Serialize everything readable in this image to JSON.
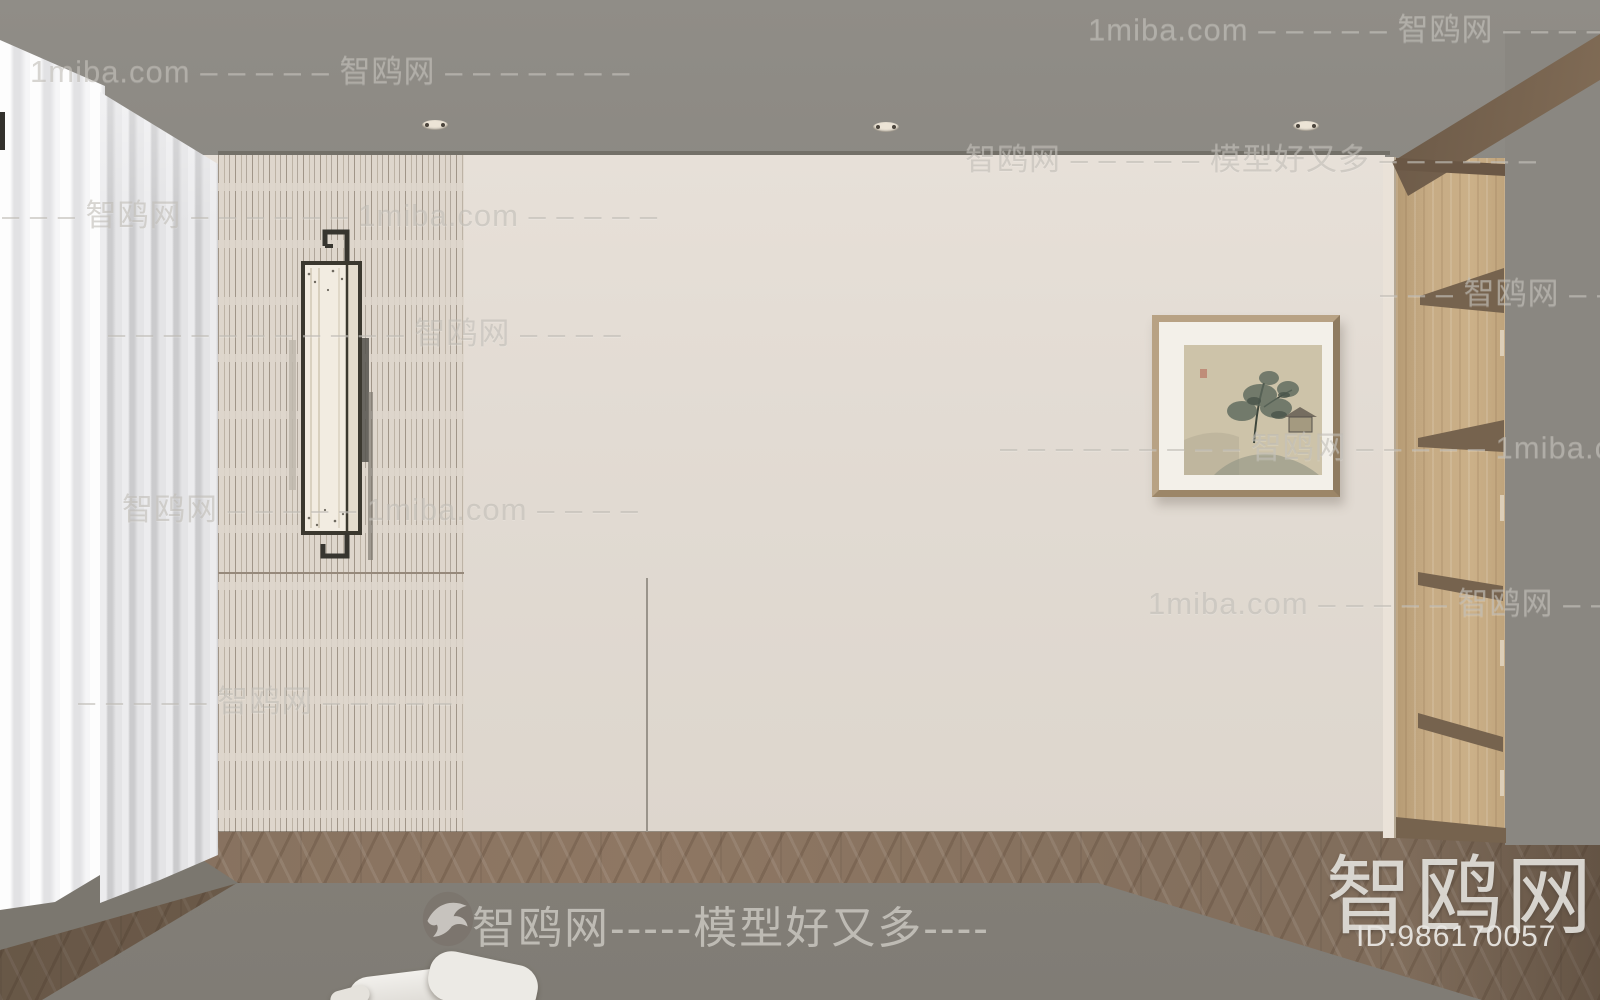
{
  "palette": {
    "ceiling": "#8e8b85",
    "wall": "#e4ddd5",
    "slat_panel": "#ded6cc",
    "curtain": "#f3f3f4",
    "wood_floor": "#8b7360",
    "rug": "#8a867e",
    "shelf_wood": "#c2a67e",
    "shelf_dark": "#76634e",
    "frame_wood": "#b8a284",
    "watermark_gray": "#beb6b0",
    "logo_white": "#e8e6e2"
  },
  "watermarks": {
    "rows": [
      {
        "text": "1miba.com – – – – – 智鸥网 – – – – – –"
      },
      {
        "text": "1miba.com – – – – – 智鸥网 – – – – – – –"
      },
      {
        "text": "智鸥网 – – – – – 模型好又多 – – – – – –"
      },
      {
        "text": "– – – 智鸥网 – – – – – – 1miba.com – – – – –"
      },
      {
        "text": "– – – 智鸥网 – –"
      },
      {
        "text": "– – – – – – – – – – – 智鸥网 – – – –"
      },
      {
        "text": "– – – – – – – – – 智鸥网 – – – – – 1miba.com – – –"
      },
      {
        "text": "智鸥网 – – – – – 1miba.com – – – –"
      },
      {
        "text": "1miba.com – – – – – 智鸥网 – – – – –"
      },
      {
        "text": "– – – – – 智鸥网 – – – – –"
      }
    ],
    "footer_tagline": "智鸥网-----模型好又多----",
    "logo_text": "智鸥网",
    "asset_id": "ID:986170057"
  },
  "icons": {
    "bird": "swallow-silhouette-in-oval"
  }
}
